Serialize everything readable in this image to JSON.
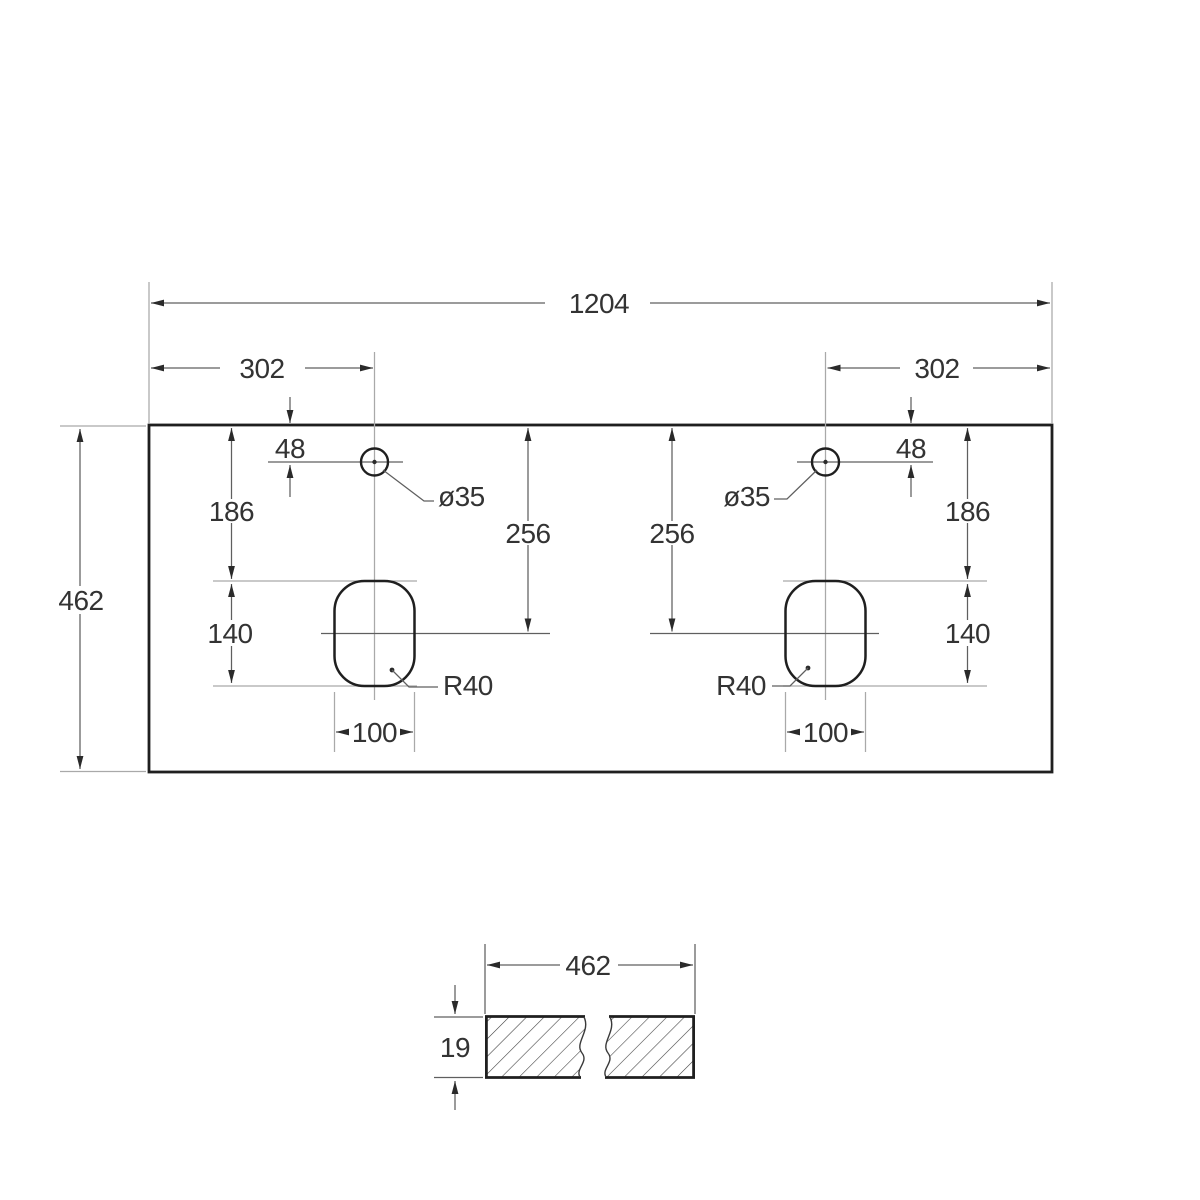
{
  "drawing": {
    "type": "technical-dimension-drawing",
    "views": {
      "top_view": "countertop plan with two faucet holes and two rounded rectangular cutouts",
      "section_view": "hatched cross-section with break lines"
    }
  },
  "labels": {
    "overall_width": "1204",
    "overall_depth": "462",
    "hole_offset_left": "302",
    "hole_offset_right": "302",
    "hole_setback_left": "48",
    "hole_setback_right": "48",
    "hole_diameter_left": "ø35",
    "hole_diameter_right": "ø35",
    "cutout_top_offset_left": "186",
    "cutout_top_offset_right": "186",
    "cutout_center_depth_left": "256",
    "cutout_center_depth_right": "256",
    "cutout_length_left": "140",
    "cutout_length_right": "140",
    "cutout_width_left": "100",
    "cutout_width_right": "100",
    "cutout_corner_radius_left": "R40",
    "cutout_corner_radius_right": "R40",
    "section_width": "462",
    "section_thickness": "19"
  },
  "colors": {
    "background": "#ffffff",
    "part_outline": "#1f1f1f",
    "dimension_lines": "#5f5f5f",
    "extension_lines": "#a9a9a9",
    "text": "#333333"
  }
}
